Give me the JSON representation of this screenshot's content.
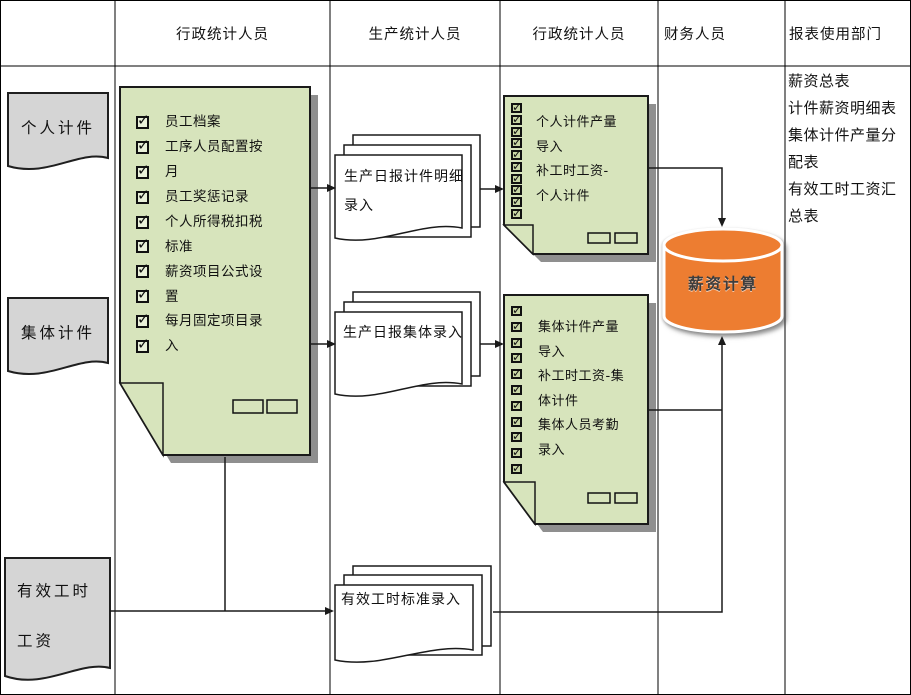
{
  "lanes": [
    {
      "label": ""
    },
    {
      "label": "行政统计人员"
    },
    {
      "label": "生产统计人员"
    },
    {
      "label": "行政统计人员"
    },
    {
      "label": "财务人员"
    },
    {
      "label": "报表使用部门"
    }
  ],
  "row_labels": {
    "personal": "个人计件",
    "collective": "集体计件",
    "effective_line1": "有效工时",
    "effective_line2": "工资"
  },
  "admin_master_box": {
    "items": [
      "员工档案",
      "工序人员配置按",
      "月",
      "员工奖惩记录",
      "个人所得税扣税",
      "标准",
      "薪资项目公式设",
      "置",
      "每月固定项目录",
      "入"
    ]
  },
  "production_docs": {
    "piecework_daily": {
      "line1": "生产日报计件明细",
      "line2": "录入"
    },
    "collective_daily": {
      "line1": "生产日报集体录入"
    },
    "effective_hours": {
      "line1": "有效工时标准录入"
    }
  },
  "admin_import_personal": {
    "items": [
      "个人计件产量",
      "导入",
      "补工时工资-",
      "个人计件"
    ]
  },
  "admin_import_collective": {
    "items": [
      "集体计件产量",
      "导入",
      "补工时工资-集",
      "体计件",
      "集体人员考勤",
      "录入"
    ]
  },
  "database": {
    "label": "薪资计算"
  },
  "reports": {
    "items": [
      "薪资总表",
      "计件薪资明细表",
      "集体计件产量分配表",
      "有效工时工资汇总表"
    ]
  },
  "colors": {
    "box_green": "#D7E4BC",
    "label_gray": "#D5D5D5",
    "db_orange": "#ED7D31",
    "line": "#1a1a1a",
    "shadow": "#8f8f8f"
  }
}
